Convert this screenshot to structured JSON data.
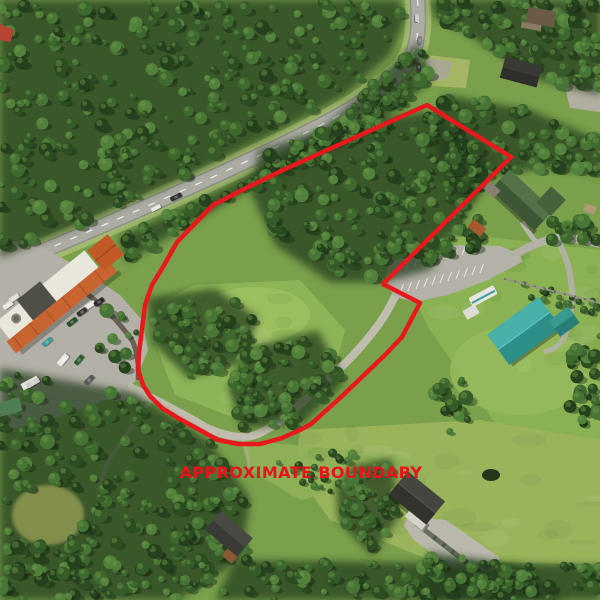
{
  "image": {
    "width": 600,
    "height": 600,
    "description": "Aerial drone photo of a forested property parcel outlined with a red approximate-boundary polygon, beside a highway, strip mall and neighboring houses"
  },
  "annotation": {
    "label": "APPROXIMATE BOUNDARY",
    "color": "#e8131b",
    "x": 301,
    "y": 478,
    "font_size": 16,
    "letter_spacing": 0.4
  },
  "boundary": {
    "color": "#e8191d",
    "stroke_width": 4.5,
    "points": [
      [
        427,
        105
      ],
      [
        511,
        157
      ],
      [
        383,
        284
      ],
      [
        420,
        303
      ],
      [
        402,
        337
      ],
      [
        385,
        355
      ],
      [
        340,
        398
      ],
      [
        311,
        424
      ],
      [
        300,
        430
      ],
      [
        282,
        438
      ],
      [
        260,
        444
      ],
      [
        238,
        444
      ],
      [
        218,
        440
      ],
      [
        198,
        429
      ],
      [
        178,
        418
      ],
      [
        162,
        408
      ],
      [
        150,
        396
      ],
      [
        143,
        385
      ],
      [
        138,
        370
      ],
      [
        139,
        353
      ],
      [
        145,
        305
      ],
      [
        152,
        285
      ],
      [
        163,
        267
      ],
      [
        177,
        242
      ],
      [
        213,
        205
      ],
      [
        246,
        188
      ],
      [
        283,
        170
      ]
    ]
  },
  "features": [
    {
      "name": "highway",
      "kind": "road",
      "note": "two-lane highway running diagonally across upper left, curving north off the top edge"
    },
    {
      "name": "strip-mall",
      "kind": "building",
      "note": "orange and white roofed retail strip at left with parking lot"
    },
    {
      "name": "mall-parking-lot",
      "kind": "parking",
      "vehicle_count": 11
    },
    {
      "name": "gravel-driveway",
      "kind": "road",
      "note": "gravel drive crossing the parcel from southwest to the parking area"
    },
    {
      "name": "property-parking-lot",
      "kind": "parking",
      "striped": true
    },
    {
      "name": "green-roof-house",
      "kind": "building",
      "note": "dark green roofed house upper right"
    },
    {
      "name": "teal-roof-building",
      "kind": "building",
      "note": "large teal gable roof building at right"
    },
    {
      "name": "white-rv-trailer",
      "kind": "vehicle"
    },
    {
      "name": "dark-roof-house-south",
      "kind": "building",
      "note": "black roofed house with wide concrete driveway apron at bottom"
    },
    {
      "name": "dark-roof-house-southwest",
      "kind": "building",
      "note": "gray roofed house tucked in trees bottom left"
    },
    {
      "name": "hillside-forest",
      "kind": "vegetation",
      "note": "dense conifer forest covering upper-left hillside and parcel"
    },
    {
      "name": "meadow-clearings",
      "kind": "vegetation",
      "note": "grassy clearings inside parcel and across right/bottom"
    },
    {
      "name": "fence-line",
      "kind": "fence"
    },
    {
      "name": "pond",
      "kind": "water"
    },
    {
      "name": "rock-retaining-wall",
      "kind": "wall"
    }
  ],
  "palette": {
    "boundary_red": "#e8191d",
    "label_red": "#e8131b",
    "meadow_base": "#7aa04c",
    "meadow_light": "#8db557",
    "meadow_bright": "#9fc162",
    "meadow_yellow": "#9ab45c",
    "forest_dark": "#223b1a",
    "tree_greens": [
      "#24401c",
      "#2c4c21",
      "#355c28",
      "#3d682e",
      "#477536",
      "#52813c"
    ],
    "tree_highlight": "#6f9a4a",
    "tree_shadow": "#16240f",
    "asphalt": "#8f8f89",
    "asphalt_light": "#acaca4",
    "gravel": "#c0bcae",
    "parking": "#b3b1a8",
    "stripe_white": "#e8e8e2",
    "verge": "#a6bc72",
    "mall_orange": "#c76430",
    "mall_orange_dark": "#a84f24",
    "mall_white_roof": "#e9e6dc",
    "mall_dark_shingle": "#504f47",
    "house_green_roof": "#3d5635",
    "house_green_roof_light": "#54714a",
    "teal_roof": "#2e8e88",
    "teal_roof_light": "#49b0a8",
    "dark_roof": "#33332e",
    "dark_roof_light": "#45453f",
    "brown_wall": "#8a5a38",
    "rv_white": "#e6e6e0",
    "shed_white": "#dcdcd4",
    "rock": "#b5b0a4",
    "wall_rock": "#5f564b",
    "pond": "#26351b",
    "fence": "#98948a",
    "apron": "#bab7ac"
  }
}
